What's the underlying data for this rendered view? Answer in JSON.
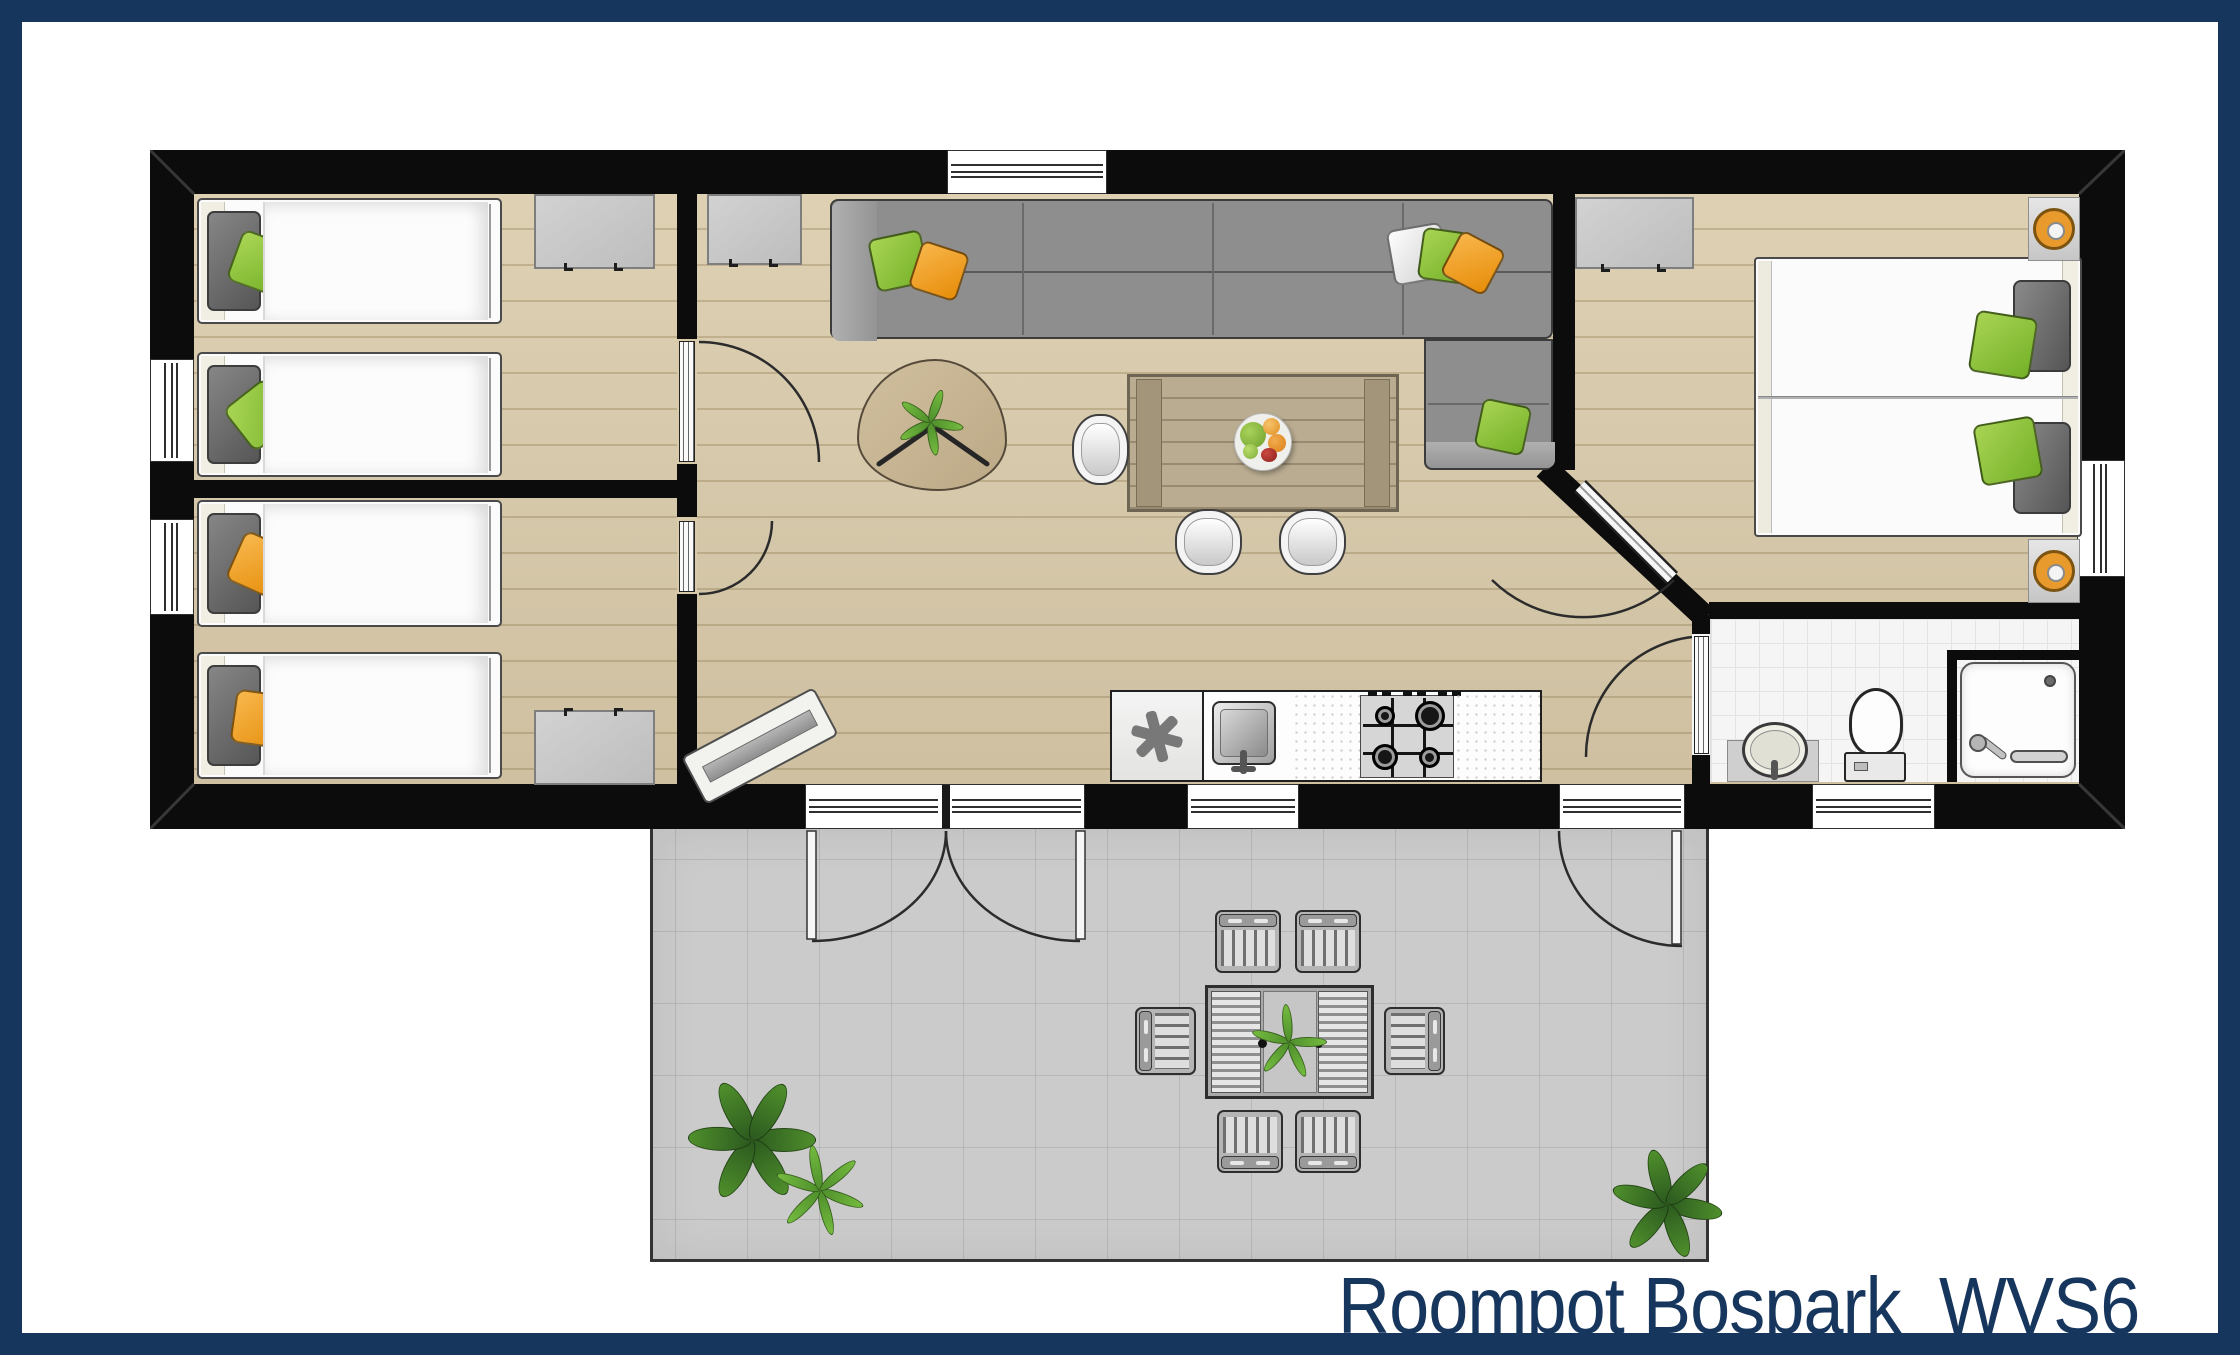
{
  "title": {
    "text": "Roompot Bospark  WVS6"
  },
  "colors": {
    "frame_navy": "#17365d",
    "wall_black": "#0c0c0c",
    "wood_floor": "#d9caa9",
    "terrace_gray": "#cbcbcb",
    "accent_green": "#8cc63e",
    "accent_orange": "#f2a22e",
    "tile_white": "#f5f5f5"
  }
}
